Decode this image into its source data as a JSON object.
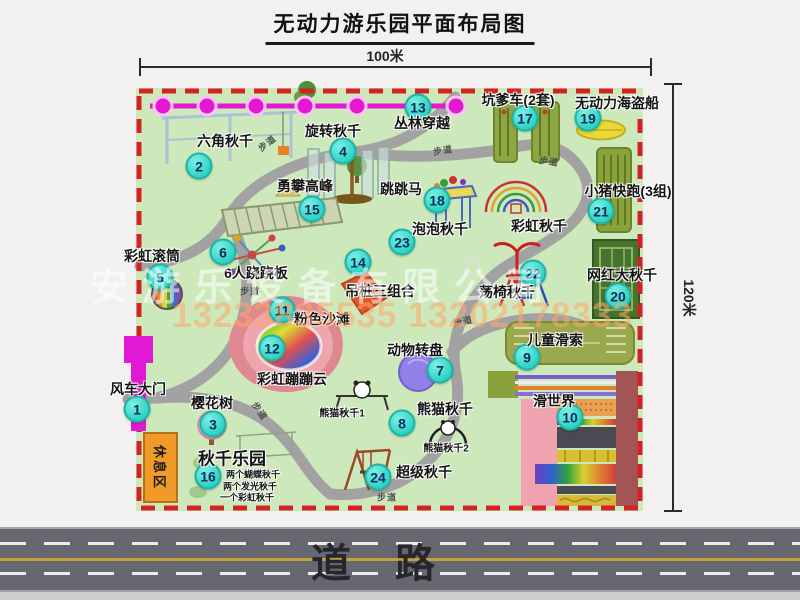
{
  "title": "无动力游乐园平面布局图",
  "dimension_top": "100米",
  "dimension_right": "120米",
  "road_label": "道路",
  "rest_area_label": "休息区",
  "trail_label": "步道",
  "watermark": {
    "line1": "安游乐设备有限公司",
    "line2": "13233835535 13202178333"
  },
  "colors": {
    "park_green": "#cde9bc",
    "border_red": "#d32222",
    "path_gray": "#a2a2a2",
    "marker_cyan": "#2fd3c4",
    "zipline_magenta": "#e318d0",
    "gate_magenta": "#e019d5",
    "rest_area_orange": "#f09a28",
    "road_gray": "#67676f",
    "pirate_ship_yellow": "#e8d838"
  },
  "pois": [
    {
      "num": "1",
      "label": "风车大门",
      "marker": [
        137,
        409
      ],
      "label_pos": [
        138,
        389
      ]
    },
    {
      "num": "2",
      "label": "六角秋千",
      "marker": [
        199,
        166
      ],
      "label_pos": [
        225,
        141
      ]
    },
    {
      "num": "3",
      "label": "樱花树",
      "marker": [
        213,
        424
      ],
      "label_pos": [
        212,
        403
      ]
    },
    {
      "num": "4",
      "label": "旋转秋千",
      "marker": [
        343,
        151
      ],
      "label_pos": [
        333,
        131
      ]
    },
    {
      "num": "5",
      "label": "彩虹滚筒",
      "marker": [
        160,
        277
      ],
      "label_pos": [
        152,
        256
      ]
    },
    {
      "num": "6",
      "label": "6人跷跷板",
      "marker": [
        223,
        252
      ],
      "label_pos": [
        256,
        273
      ]
    },
    {
      "num": "7",
      "label": "动物转盘",
      "marker": [
        440,
        370
      ],
      "label_pos": [
        415,
        350
      ]
    },
    {
      "num": "8",
      "label": "熊猫秋千",
      "marker": [
        402,
        423
      ],
      "label_pos": [
        445,
        409
      ]
    },
    {
      "num": "9",
      "label": "儿童滑索",
      "marker": [
        527,
        357
      ],
      "label_pos": [
        555,
        340
      ]
    },
    {
      "num": "10",
      "label": "滑世界",
      "marker": [
        570,
        417
      ],
      "label_pos": [
        554,
        401
      ]
    },
    {
      "num": "11",
      "label": "粉色沙滩",
      "marker": [
        282,
        310
      ],
      "label_pos": [
        322,
        319
      ]
    },
    {
      "num": "12",
      "label": "彩虹蹦蹦云",
      "marker": [
        272,
        348
      ],
      "label_pos": [
        292,
        379
      ]
    },
    {
      "num": "13",
      "label": "丛林穿越",
      "marker": [
        418,
        107
      ],
      "label_pos": [
        422,
        123
      ]
    },
    {
      "num": "14",
      "label": "吊桩三组合",
      "marker": [
        358,
        262
      ],
      "label_pos": [
        380,
        291
      ]
    },
    {
      "num": "15",
      "label": "勇攀高峰",
      "marker": [
        312,
        209
      ],
      "label_pos": [
        305,
        186
      ]
    },
    {
      "num": "16",
      "label": "秋千乐园",
      "marker": [
        208,
        476
      ],
      "label_pos": [
        232,
        457
      ],
      "size": 17
    },
    {
      "num": "17",
      "label": "坑爹车(2套)",
      "marker": [
        525,
        118
      ],
      "label_pos": [
        518,
        100
      ]
    },
    {
      "num": "18",
      "label": "跳跳马",
      "marker": [
        437,
        200
      ],
      "label_pos": [
        401,
        189
      ]
    },
    {
      "num": "19",
      "label": "无动力海盗船",
      "marker": [
        588,
        118
      ],
      "label_pos": [
        617,
        103
      ]
    },
    {
      "num": "20",
      "label": "网红大秋千",
      "marker": [
        618,
        296
      ],
      "label_pos": [
        622,
        275
      ]
    },
    {
      "num": "21",
      "label": "小猪快跑(3组)",
      "marker": [
        601,
        211
      ],
      "label_pos": [
        628,
        191
      ]
    },
    {
      "num": "22",
      "label": "荡椅秋千",
      "marker": [
        533,
        273
      ],
      "label_pos": [
        507,
        292
      ]
    },
    {
      "num": "23",
      "label": "泡泡秋千",
      "marker": [
        402,
        242
      ],
      "label_pos": [
        440,
        229
      ]
    },
    {
      "num": "24",
      "label": "超级秋千",
      "marker": [
        378,
        477
      ],
      "label_pos": [
        424,
        472
      ]
    }
  ],
  "extra_labels": [
    {
      "text": "彩虹秋千",
      "pos": [
        539,
        226
      ],
      "size": 14
    },
    {
      "text": "熊猫秋千1",
      "pos": [
        342,
        412
      ],
      "size": 10
    },
    {
      "text": "熊猫秋千2",
      "pos": [
        446,
        447
      ],
      "size": 10
    },
    {
      "text": "两个蝴蝶秋千",
      "pos": [
        253,
        474
      ],
      "size": 9
    },
    {
      "text": "两个发光秋千",
      "pos": [
        250,
        486
      ],
      "size": 9
    },
    {
      "text": "一个彩虹秋千",
      "pos": [
        247,
        497
      ],
      "size": 9
    }
  ],
  "trail_labels": [
    {
      "pos": [
        267,
        143
      ],
      "rot": -38
    },
    {
      "pos": [
        443,
        150
      ],
      "rot": -10
    },
    {
      "pos": [
        549,
        161
      ],
      "rot": 8
    },
    {
      "pos": [
        250,
        291
      ],
      "rot": 0
    },
    {
      "pos": [
        463,
        321
      ],
      "rot": -12
    },
    {
      "pos": [
        260,
        411
      ],
      "rot": 55
    },
    {
      "pos": [
        387,
        497
      ],
      "rot": 0
    }
  ]
}
